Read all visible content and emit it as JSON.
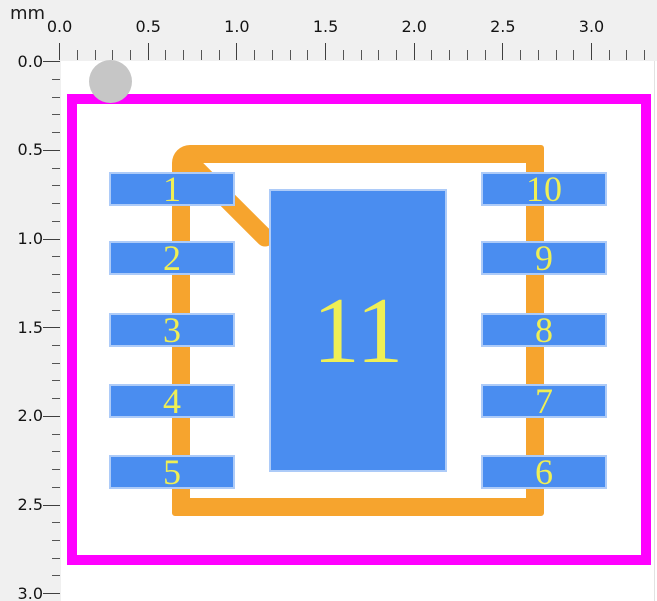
{
  "ruler": {
    "unit_label": "mm",
    "top_labels": [
      "0.0",
      "0.5",
      "1.0",
      "1.5",
      "2.0",
      "2.5",
      "3.0"
    ],
    "left_labels": [
      "0.0",
      "0.5",
      "1.0",
      "1.5",
      "2.0",
      "2.5",
      "3.0"
    ],
    "major_step_mm": 0.5,
    "minor_step_mm": 0.1,
    "top_origin_px": 59.6,
    "left_origin_px": 61.8,
    "minor_step_px": 17.73,
    "top_tick_count": 34,
    "left_tick_count": 31
  },
  "footprint": {
    "courtyard": {
      "x": 67,
      "y": 94,
      "w": 584,
      "h": 471,
      "stroke": 10,
      "color": "#ff00ff"
    },
    "outline": {
      "x": 172,
      "y": 145,
      "w": 372,
      "h": 371,
      "stroke": 18,
      "color": "#f6a42e"
    },
    "chamfer": {
      "cx": 226,
      "cy": 199,
      "length": 127,
      "stroke": 18,
      "angle_deg": 45
    },
    "pin1_marker": {
      "cx": 110.5,
      "cy": 81.5,
      "r": 21.5,
      "color": "#c6c6c6"
    },
    "pads": [
      {
        "label": "1",
        "x": 109,
        "y": 172,
        "w": 126,
        "h": 34,
        "font": 36
      },
      {
        "label": "2",
        "x": 109,
        "y": 241,
        "w": 126,
        "h": 34,
        "font": 36
      },
      {
        "label": "3",
        "x": 109,
        "y": 313,
        "w": 126,
        "h": 34,
        "font": 36
      },
      {
        "label": "4",
        "x": 109,
        "y": 384,
        "w": 126,
        "h": 34,
        "font": 36
      },
      {
        "label": "5",
        "x": 109,
        "y": 455,
        "w": 126,
        "h": 34,
        "font": 36
      },
      {
        "label": "6",
        "x": 481,
        "y": 455,
        "w": 126,
        "h": 34,
        "font": 36
      },
      {
        "label": "7",
        "x": 481,
        "y": 384,
        "w": 126,
        "h": 34,
        "font": 36
      },
      {
        "label": "8",
        "x": 481,
        "y": 313,
        "w": 126,
        "h": 34,
        "font": 36
      },
      {
        "label": "9",
        "x": 481,
        "y": 241,
        "w": 126,
        "h": 34,
        "font": 36
      },
      {
        "label": "10",
        "x": 481,
        "y": 172,
        "w": 126,
        "h": 34,
        "font": 36
      },
      {
        "label": "11",
        "x": 269,
        "y": 189,
        "w": 178,
        "h": 283,
        "font": 94
      }
    ]
  },
  "colors": {
    "pad_fill": "#4a8df0",
    "pad_text": "#efef55",
    "silkscreen": "#f6a42e",
    "courtyard": "#ff00ff",
    "pin1_marker": "#c6c6c6",
    "ruler_bg": "#f0f0f0",
    "canvas_bg": "#ffffff"
  }
}
